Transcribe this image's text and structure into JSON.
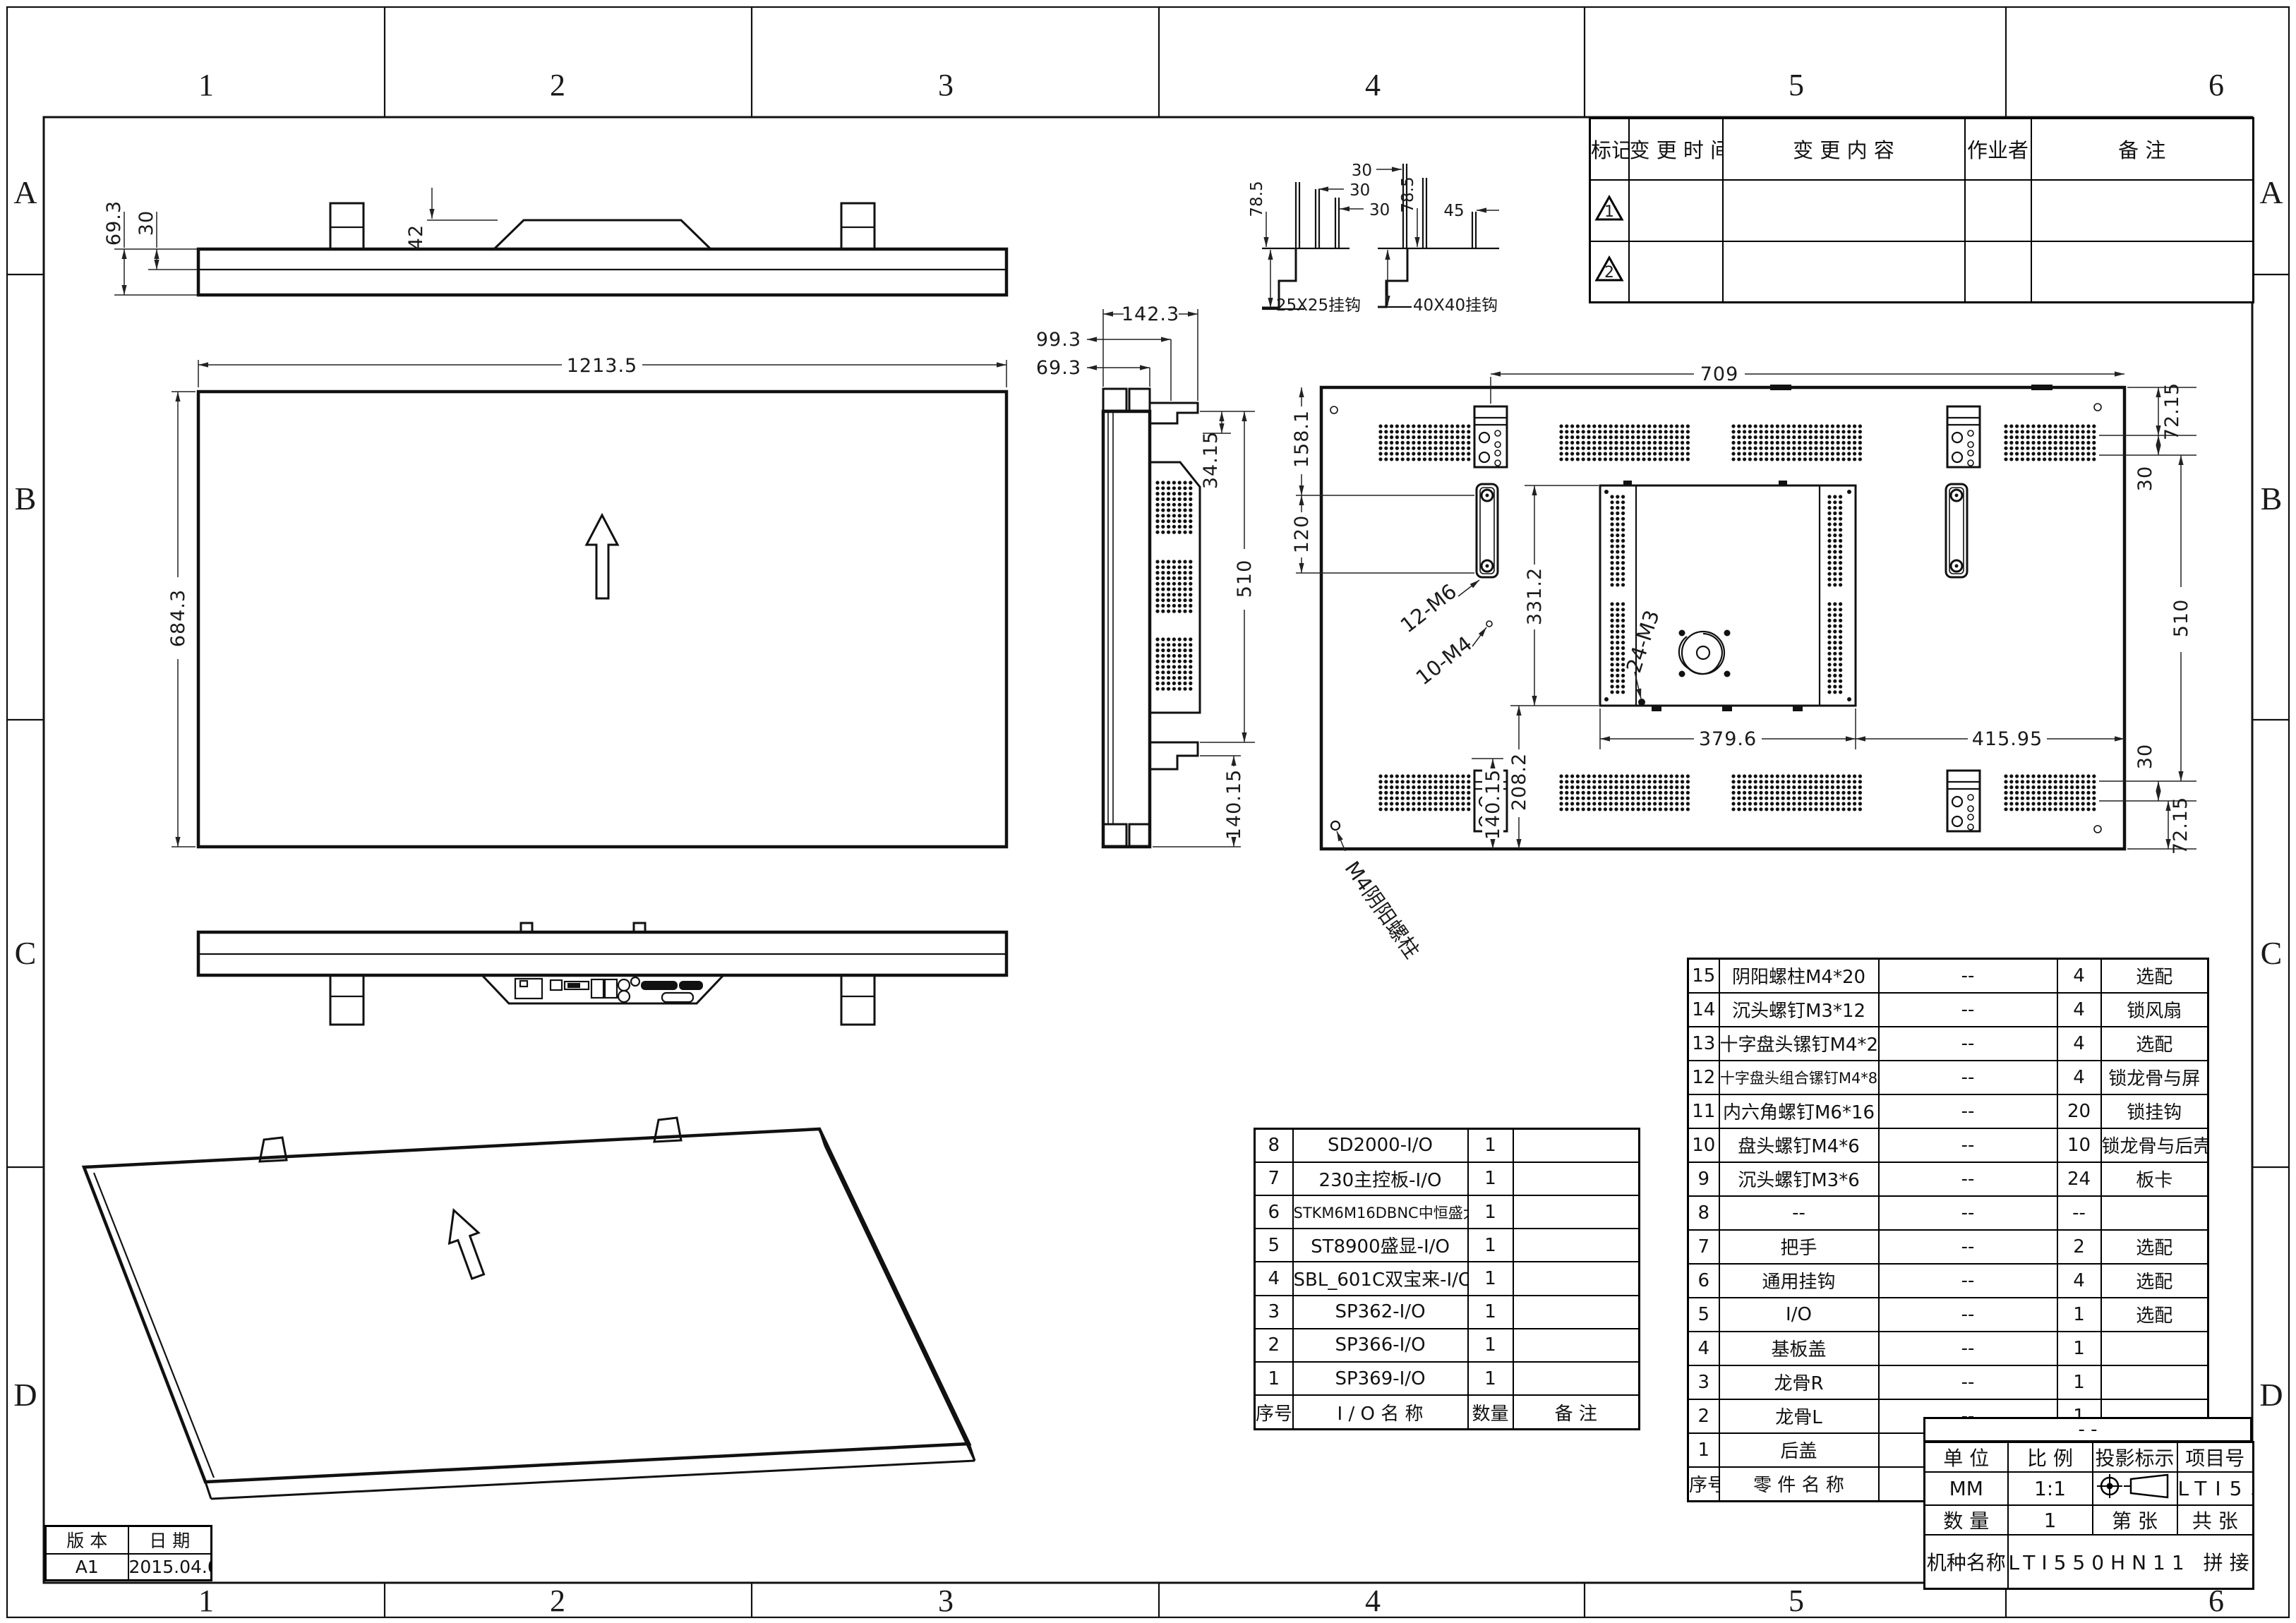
{
  "frame": {
    "zone_numbers": [
      "1",
      "2",
      "3",
      "4",
      "5",
      "6"
    ],
    "zone_letters": [
      "A",
      "B",
      "C",
      "D"
    ]
  },
  "revision_table": {
    "headers": [
      "标记",
      "变 更 时 间",
      "变  更  内  容",
      "作业者",
      "备    注"
    ],
    "rows": [
      {
        "marker": "1"
      },
      {
        "marker": "2"
      }
    ]
  },
  "dims": {
    "tv_69_3": "69.3",
    "tv_30": "30",
    "tv_42": "42",
    "fv_1213_5": "1213.5",
    "fv_684_3": "684.3",
    "h1_78_5": "78.5",
    "h1_30a": "30",
    "h1_30b": "30",
    "h2_30": "30",
    "h2_78_5": "78.5",
    "h2_45": "45",
    "sv_142_3": "142.3",
    "sv_99_3": "99.3",
    "sv_69_3": "69.3",
    "sv_34_15": "34.15",
    "sv_510": "510",
    "sv_140_15": "140.15",
    "rv_709": "709",
    "rv_72_15_t": "72.15",
    "rv_30_t": "30",
    "rv_510": "510",
    "rv_30_b": "30",
    "rv_72_15_b": "72.15",
    "rv_158_1": "158.1",
    "rv_120": "120",
    "rv_331_2": "331.2",
    "rv_379_6": "379.6",
    "rv_415_95": "415.95",
    "rv_208_2": "208.2",
    "rv_140_15": "140.15"
  },
  "callouts": {
    "m6": "12-M6",
    "m4": "10-M4",
    "m3": "24-M3",
    "stud": "M4阴阳螺柱",
    "hook_small": "25X25挂钩",
    "hook_big": "40X40挂钩"
  },
  "io_table": {
    "headers": [
      "序号",
      "I / O   名   称",
      "数量",
      "备    注"
    ],
    "rows": [
      {
        "no": "8",
        "name": "SD2000-I/O",
        "qty": "1",
        "remark": ""
      },
      {
        "no": "7",
        "name": "230主控板-I/O",
        "qty": "1",
        "remark": ""
      },
      {
        "no": "6",
        "name": "STKM6M16DBNC中恒盛大-I/O",
        "qty": "1",
        "remark": ""
      },
      {
        "no": "5",
        "name": "ST8900盛显-I/O",
        "qty": "1",
        "remark": ""
      },
      {
        "no": "4",
        "name": "SBL_601C双宝来-I/O",
        "qty": "1",
        "remark": ""
      },
      {
        "no": "3",
        "name": "SP362-I/O",
        "qty": "1",
        "remark": ""
      },
      {
        "no": "2",
        "name": "SP366-I/O",
        "qty": "1",
        "remark": ""
      },
      {
        "no": "1",
        "name": "SP369-I/O",
        "qty": "1",
        "remark": ""
      }
    ]
  },
  "bom_table": {
    "headers": [
      "序号",
      "零  件  名  称",
      "规          格",
      "数量",
      "备    注"
    ],
    "rows": [
      {
        "no": "15",
        "name": "阴阳螺柱M4*20",
        "spec": "--",
        "qty": "4",
        "remark": "选配"
      },
      {
        "no": "14",
        "name": "沉头螺钉M3*12",
        "spec": "--",
        "qty": "4",
        "remark": "锁风扇"
      },
      {
        "no": "13",
        "name": "十字盘头镙钉M4*25",
        "spec": "--",
        "qty": "4",
        "remark": "选配"
      },
      {
        "no": "12",
        "name": "十字盘头组合镙钉M4*8",
        "spec": "--",
        "qty": "4",
        "remark": "锁龙骨与屏"
      },
      {
        "no": "11",
        "name": "内六角螺钉M6*16",
        "spec": "--",
        "qty": "20",
        "remark": "锁挂钩"
      },
      {
        "no": "10",
        "name": "盘头螺钉M4*6",
        "spec": "--",
        "qty": "10",
        "remark": "锁龙骨与后壳"
      },
      {
        "no": "9",
        "name": "沉头螺钉M3*6",
        "spec": "--",
        "qty": "24",
        "remark": "板卡"
      },
      {
        "no": "8",
        "name": "--",
        "spec": "--",
        "qty": "--",
        "remark": ""
      },
      {
        "no": "7",
        "name": "把手",
        "spec": "--",
        "qty": "2",
        "remark": "选配"
      },
      {
        "no": "6",
        "name": "通用挂钩",
        "spec": "--",
        "qty": "4",
        "remark": "选配"
      },
      {
        "no": "5",
        "name": "I/O",
        "spec": "--",
        "qty": "1",
        "remark": "选配"
      },
      {
        "no": "4",
        "name": "基板盖",
        "spec": "--",
        "qty": "1",
        "remark": ""
      },
      {
        "no": "3",
        "name": "龙骨R",
        "spec": "--",
        "qty": "1",
        "remark": ""
      },
      {
        "no": "2",
        "name": "龙骨L",
        "spec": "--",
        "qty": "1",
        "remark": ""
      },
      {
        "no": "1",
        "name": "后盖",
        "spec": "--",
        "qty": "1",
        "remark": ""
      }
    ]
  },
  "title_block": {
    "dash": "- -",
    "unit_label": "单 位",
    "unit": "MM",
    "scale_label": "比 例",
    "scale": "1:1",
    "projection_label": "投影标示",
    "project_label": "项目号",
    "project": "LTI550HN",
    "qty_label": "数 量",
    "qty": "1",
    "sheet_label": "第      张",
    "total_label": "共      张",
    "model_label": "机种名称",
    "model": "LTI550HN11  拼接外"
  },
  "version_table": {
    "version_label": "版  本",
    "date_label": "日  期",
    "version": "A1",
    "date": "2015.04.09"
  }
}
